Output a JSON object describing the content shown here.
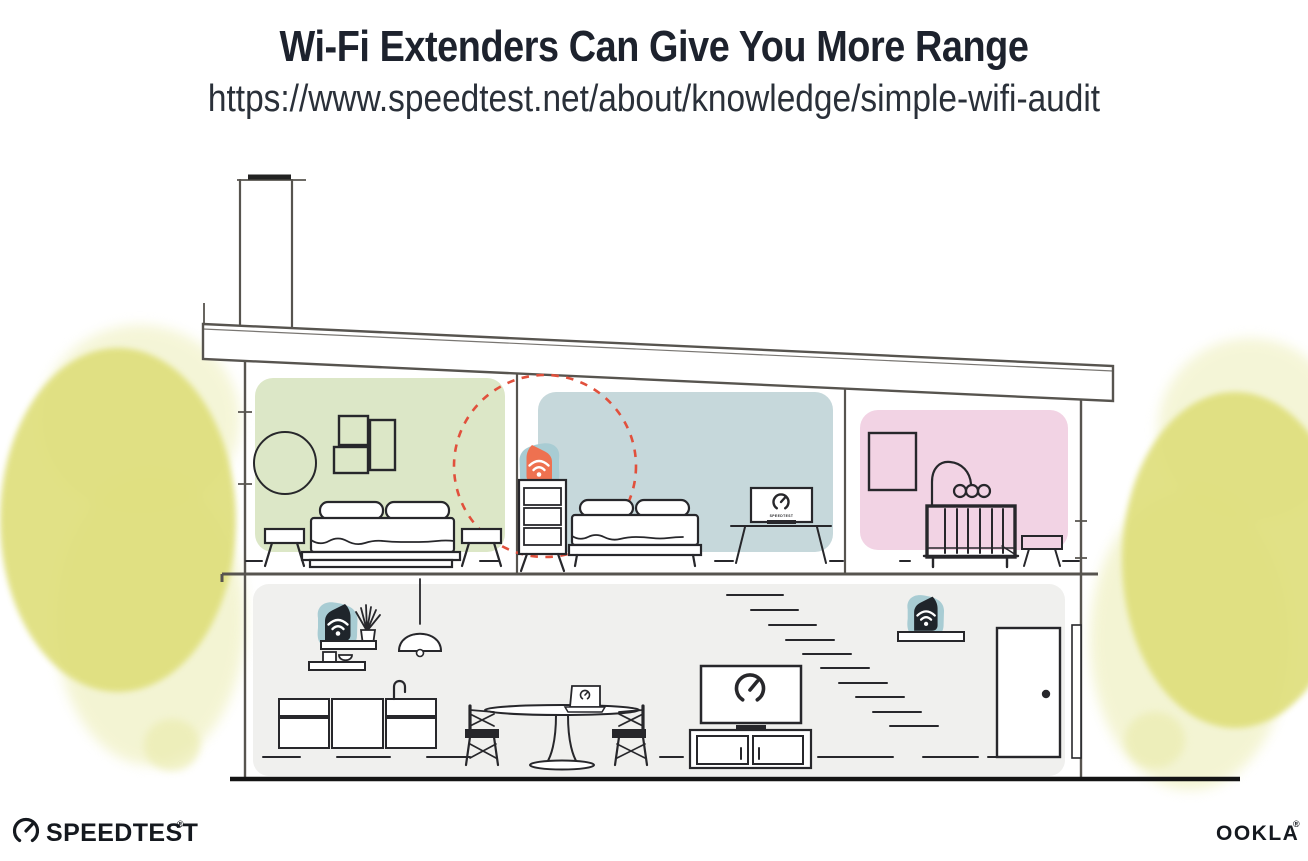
{
  "header": {
    "title": "Wi-Fi Extenders Can Give You More Range",
    "url": "https://www.speedtest.net/about/knowledge/simple-wifi-audit"
  },
  "footer": {
    "speedtest_wordmark": "SPEEDTEST",
    "ookla_wordmark": "OOKLA",
    "registered_mark": "®"
  },
  "illustration": {
    "tv_screen_label": "SPEEDTEST",
    "colors": {
      "line": "#57544f",
      "furniture_line": "#27272b",
      "room_green": "#dce7c7",
      "room_blue": "#c6d8db",
      "room_pink": "#f2d3e4",
      "lower_floor_gray": "#f0f0ee",
      "device_teal": "#a8ccd3",
      "extender_orange": "#ee7150",
      "router_navy": "#1f252b",
      "signal_red": "#e1503c",
      "foliage_yellow": "#dfdf7c",
      "foliage_yellow_light": "#ebecb0",
      "ground": "#141414",
      "brand_dark": "#15191f"
    },
    "devices": [
      {
        "name": "wifi-router",
        "location": "downstairs-shelf"
      },
      {
        "name": "wifi-extender",
        "location": "upstairs-bedroom-dresser"
      },
      {
        "name": "wifi-extender",
        "location": "downstairs-entry-shelf"
      }
    ]
  }
}
